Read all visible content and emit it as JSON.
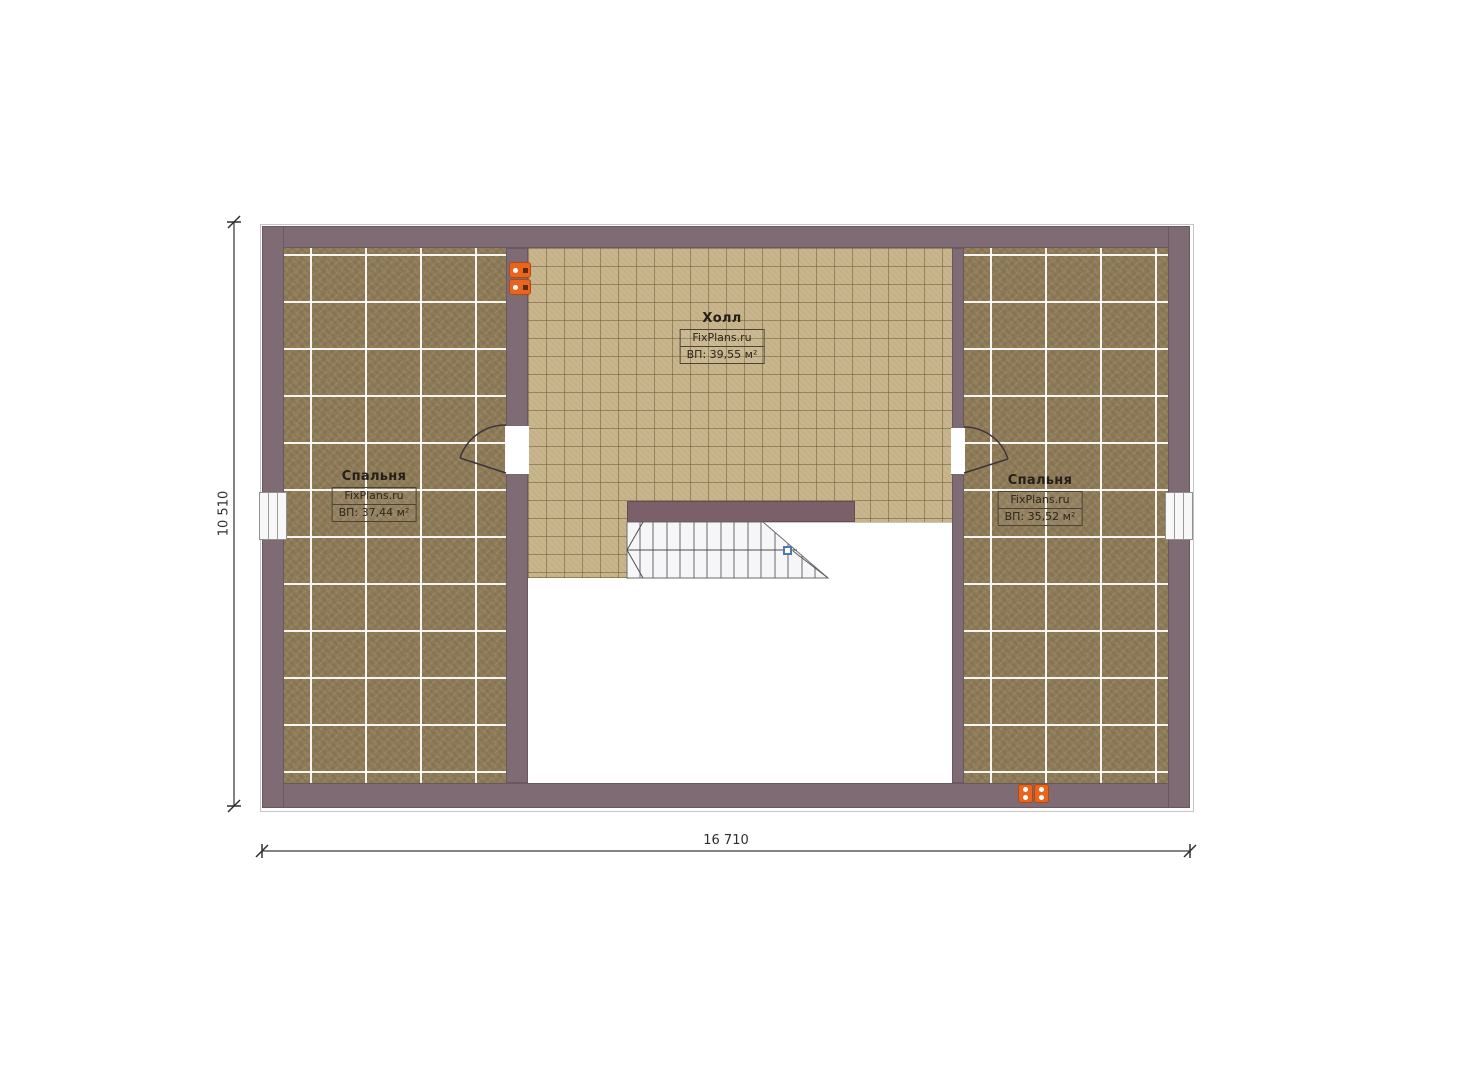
{
  "rooms": [
    {
      "name": "Спальня",
      "watermark": "FixPlans.ru",
      "area": "ВП: 37,44 м²"
    },
    {
      "name": "Холл",
      "watermark": "FixPlans.ru",
      "area": "ВП: 39,55 м²"
    },
    {
      "name": "Спальня",
      "watermark": "FixPlans.ru",
      "area": "ВП: 35,52 м²"
    }
  ],
  "dimensions": {
    "width_label": "16 710",
    "height_label": "10 510"
  },
  "icons": {
    "outlets": "power-outlet-icon",
    "stair_marker": "stair-direction-marker"
  },
  "colors": {
    "wall": "#7f6b74",
    "stairwall": "#7b5f69",
    "carpet": "#8d7a57",
    "tile": "#c9b68c",
    "accent_orange": "#e8641f",
    "marker_blue": "#4a7ab5"
  }
}
